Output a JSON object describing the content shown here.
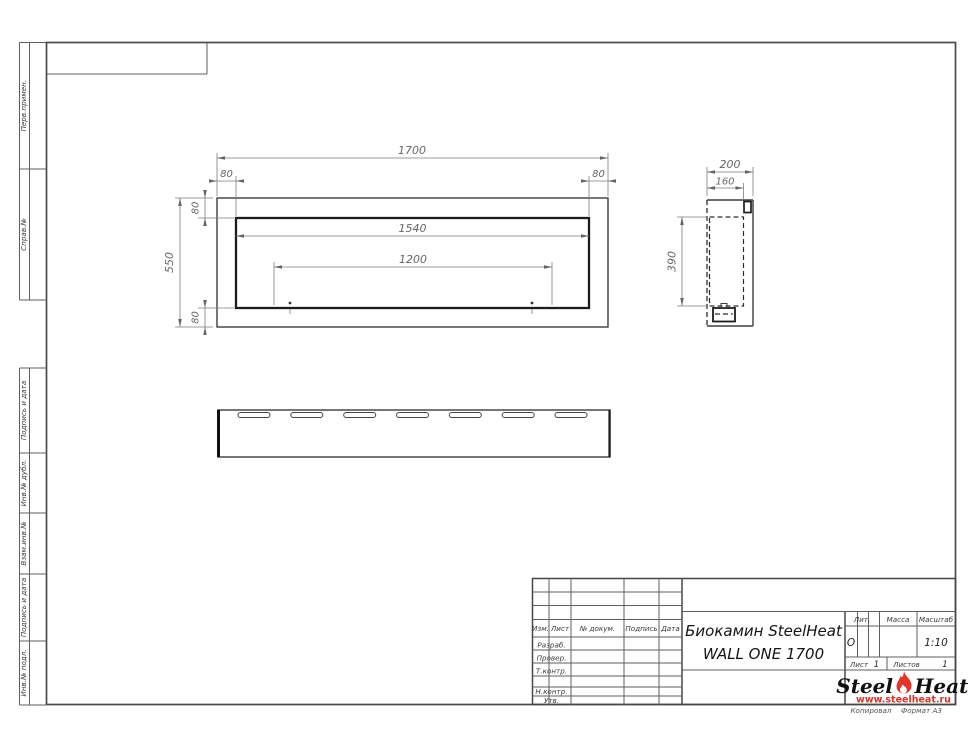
{
  "margin_labels": {
    "top": [
      "Перв.примен.",
      "Справ.№"
    ],
    "bottom": [
      "Подпись и дата",
      "Инв.№ дубл.",
      "Взам.инв.№",
      "Подпись и дата",
      "Инв.№ подл."
    ]
  },
  "dimensions": {
    "front": {
      "width": "1700",
      "height": "550",
      "inset_left": "80",
      "inset_right": "80",
      "inset_top": "80",
      "inset_bottom": "80",
      "opening_width": "1540",
      "mount_span": "1200"
    },
    "side": {
      "depth": "200",
      "inner_depth": "160",
      "opening_height": "390"
    }
  },
  "title_block": {
    "header_cols": {
      "izm": "Изм.",
      "list": "Лист",
      "doc": "№ докум.",
      "podpis": "Подпись",
      "data": "Дата"
    },
    "role_rows": {
      "razrab": "Разраб.",
      "prover": "Провер.",
      "tkontr": "Т.контр.",
      "nkontr": "Н.контр.",
      "utv": "Утв."
    },
    "doc_title_line1": "Биокамин SteelHeat",
    "doc_title_line2": "WALL ONE 1700",
    "lit_label": "Лит.",
    "lit_value": "О",
    "massa_label": "Масса",
    "masshtab_label": "Масштаб",
    "masshtab_value": "1:10",
    "list_label": "Лист",
    "list_value": "1",
    "listov_label": "Листов",
    "listov_value": "1"
  },
  "logo": {
    "word1": "Steel",
    "word2": "Heat",
    "site": "www.steelheat.ru",
    "flame_color": "#e23528",
    "site_color": "#d8342a"
  },
  "footer": {
    "copied": "Копировал",
    "format": "Формат А3"
  }
}
